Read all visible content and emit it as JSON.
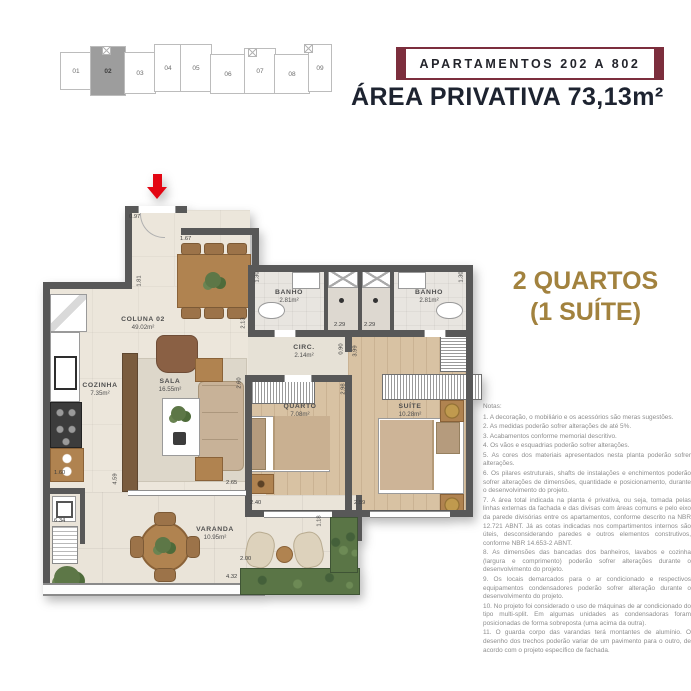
{
  "colors": {
    "maroon": "#7c2e3d",
    "title_dark": "#1d2330",
    "gold": "#a2823e",
    "arrow_red": "#e30613",
    "wall_gray": "#585858"
  },
  "keyplan": {
    "units": [
      "01",
      "02",
      "03",
      "04",
      "05",
      "06",
      "07",
      "08",
      "09"
    ],
    "highlighted_unit": "02"
  },
  "header": {
    "badge": "APARTAMENTOS 202 A 802",
    "area_title": "ÁREA PRIVATIVA 73,13m²"
  },
  "summary": {
    "line1": "2 QUARTOS",
    "line2": "(1 SUÍTE)"
  },
  "plan": {
    "rooms": {
      "coluna": {
        "name": "COLUNA 02",
        "area": "49.02m²"
      },
      "cozinha": {
        "name": "COZINHA",
        "area": "7.35m²"
      },
      "sala": {
        "name": "SALA",
        "area": "16.55m²"
      },
      "banho1": {
        "name": "BANHO",
        "area": "2.81m²"
      },
      "banho2": {
        "name": "BANHO",
        "area": "2.81m²"
      },
      "circ": {
        "name": "CIRC.",
        "area": "2.14m²"
      },
      "quarto": {
        "name": "QUARTO",
        "area": "7.08m²"
      },
      "suite": {
        "name": "SUÍTE",
        "area": "10.28m²"
      },
      "varanda": {
        "name": "VARANDA",
        "area": "10.95m²"
      }
    },
    "dims": {
      "entry": "0.97",
      "dining_w": "1.67",
      "hall_h": "1.81",
      "banho1_w": "1.30",
      "banho2_w": "1.30",
      "circ_left": "2.13",
      "shower1": "2.29",
      "shower2": "2.29",
      "circ_a": "0.90",
      "circ_b": "3.99",
      "quarto_h": "2.98",
      "sala_d": "2.60",
      "sala_w": "2.65",
      "sala_var": "4.59",
      "cozinha_w": "1.60",
      "lateral": "6.34",
      "quarto_w": "2.40",
      "suite_w": "2.59",
      "var_step": "1.18",
      "var_d": "2.00",
      "var_w": "4.32"
    }
  },
  "notes": {
    "title": "Notas:",
    "items": [
      "1. A decoração, o mobiliário e os acessórios são meras sugestões.",
      "2. As medidas poderão sofrer alterações de até 5%.",
      "3. Acabamentos conforme memorial descritivo.",
      "4. Os vãos e esquadrias poderão sofrer alterações.",
      "5. As cores dos materiais apresentados nesta planta poderão sofrer alterações.",
      "6. Os pilares estruturais, shafts de instalações e enchimentos poderão sofrer alterações de dimensões, quantidade e posicionamento, durante o desenvolvimento do projeto.",
      "7. A área total indicada na planta é privativa, ou seja, tomada pelas linhas externas da fachada e das divisas com áreas comuns e pelo eixo da parede divisórias entre os apartamentos, conforme descrito na NBR 12.721 ABNT. Já as cotas indicadas nos compartimentos internos são úteis, desconsiderando paredes e outros elementos construtivos, conforme NBR 14.653-2 ABNT.",
      "8. As dimensões das bancadas dos banheiros, lavabos e cozinha (largura e comprimento) poderão sofrer alterações durante o desenvolvimento do projeto.",
      "9. Os locais demarcados para o ar condicionado e respectivos equipamentos condensadores poderão sofrer alteração durante o desenvolvimento do projeto.",
      "10. No projeto foi considerado o uso de máquinas de ar condicionado do tipo multi-split. Em algumas unidades as condensadoras foram posicionadas de forma sobreposta (uma acima da outra).",
      "11. O guarda corpo das varandas terá montantes de alumínio. O desenho dos trechos poderão variar de um pavimento para o outro, de acordo com o projeto específico de fachada."
    ]
  }
}
